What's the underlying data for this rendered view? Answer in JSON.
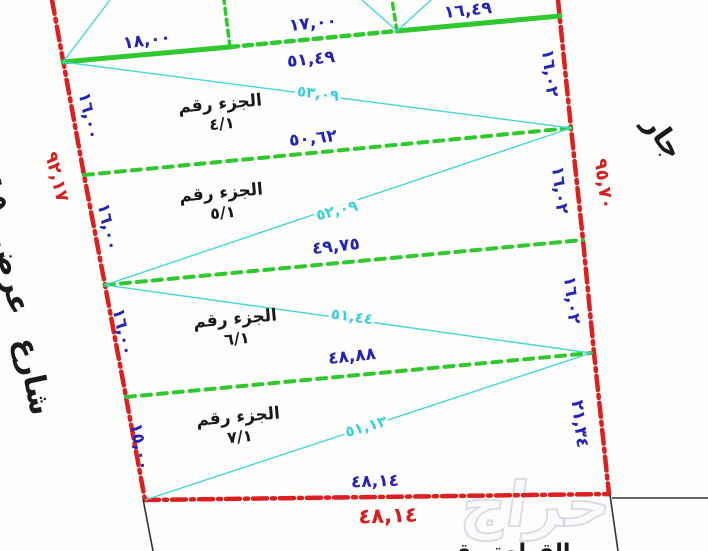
{
  "colors": {
    "boundary_red": "#dd1f1f",
    "divider_green": "#2fc82f",
    "diagonal_cyan": "#45d6d6",
    "dimension_blue": "#2425b4",
    "dimension_red": "#d41f1f",
    "text_black": "#1a1a1a"
  },
  "top_edge": {
    "seg1": "١٨,٠٠",
    "seg2": "١٧,٠٠",
    "seg3": "١٦,٤٩",
    "total": "٥١,٤٩"
  },
  "dividers": {
    "d1": "٥٠,٦٢",
    "d2": "٤٩,٧٥",
    "d3": "٤٨,٨٨"
  },
  "bottom_edge": {
    "inner": "٤٨,١٤",
    "outer": "٤٨,١٤"
  },
  "diagonals": {
    "p4": "٥٣,٠٩",
    "p5": "٥٢,٠٩",
    "p6": "٥١,٤٤",
    "p7": "٥١,١٣"
  },
  "left_edge": {
    "s1": "١٦,٠٠",
    "s2": "١٦,٠٠",
    "s3": "١٦,٠٠",
    "s4": "١٥,٠٠",
    "total": "٩٢,١٧"
  },
  "right_edge": {
    "s1": "١٦,٠٢",
    "s2": "١٦,٠٢",
    "s3": "١٦,٠٢",
    "s4": "٢١,٣٤",
    "total": "٩٥,٧٠"
  },
  "parts": {
    "p4": {
      "line1": "الجزء رقم",
      "line2": "٤/١"
    },
    "p5": {
      "line1": "الجزء رقم",
      "line2": "٥/١"
    },
    "p6": {
      "line1": "الجزء رقم",
      "line2": "٦/١"
    },
    "p7": {
      "line1": "الجزء رقم",
      "line2": "٧/١"
    }
  },
  "street_label": "شارع عرض ١٥م",
  "neighbor_label": "جار",
  "bottom_text": "القطعة رقم",
  "watermark": "حراج"
}
